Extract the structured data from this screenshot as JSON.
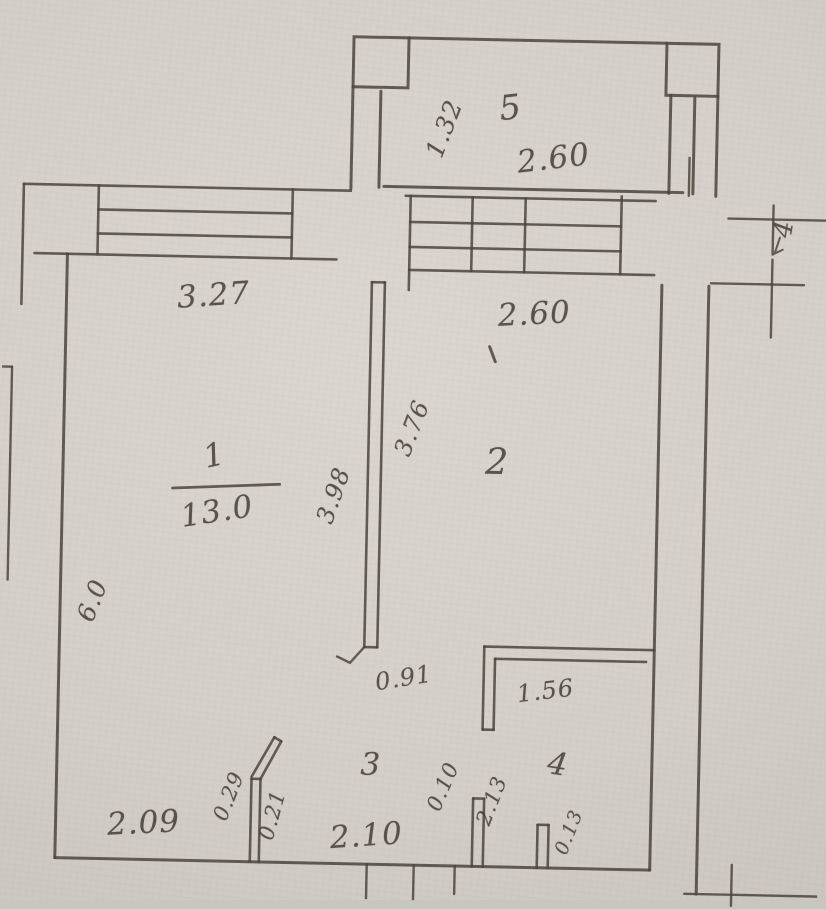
{
  "document": {
    "kind": "scanned hand-drawn apartment floor plan",
    "aria": "Scanned floor plan of an apartment with rooms 1-5 and handwritten dimensions"
  },
  "palette": {
    "paper": "#d4d0c9",
    "ink": "#4b453c",
    "text": "#3e382f"
  },
  "rooms": [
    {
      "number": "1",
      "area": "13.0",
      "width": "3.27",
      "depth": "3.98"
    },
    {
      "number": "2",
      "width": "2.60",
      "depth": "3.76"
    },
    {
      "number": "3",
      "dims": [
        "2.09",
        "0.29",
        "0.21",
        "2.10"
      ]
    },
    {
      "number": "4",
      "dims": [
        "0.10",
        "2.13",
        "0.13"
      ],
      "niche": "1.56"
    },
    {
      "number": "5",
      "width": "2.60",
      "depth": "1.32"
    }
  ],
  "doors": [
    {
      "between": "1-2",
      "width": "0.91"
    }
  ],
  "side_marks": [
    {
      "text": "4",
      "position": "right margin"
    }
  ],
  "plan": {
    "labels": [
      {
        "name": "room-5-number-label",
        "text": "5",
        "x": 503,
        "y": 106,
        "size": 34,
        "rot": -8
      },
      {
        "name": "balcony-width-dim",
        "text": "2.60",
        "x": 547,
        "y": 156,
        "size": 31,
        "rot": -8
      },
      {
        "name": "balcony-depth-dim",
        "text": "1.32",
        "x": 437,
        "y": 128,
        "size": 25,
        "rot": -70
      },
      {
        "name": "room-1-width-dim",
        "text": "3.27",
        "x": 210,
        "y": 300,
        "size": 31,
        "rot": -5
      },
      {
        "name": "room-2-width-dim",
        "text": "2.60",
        "x": 531,
        "y": 312,
        "size": 31,
        "rot": -4
      },
      {
        "name": "room-1-number-label",
        "text": "1",
        "x": 214,
        "y": 459,
        "size": 32,
        "rot": -14
      },
      {
        "name": "room-1-area-label",
        "text": "13.0",
        "x": 218,
        "y": 516,
        "size": 31,
        "rot": -10
      },
      {
        "name": "room-1-depth-dim",
        "text": "6.0",
        "x": 95,
        "y": 607,
        "size": 25,
        "rot": -70
      },
      {
        "name": "wall-1-2-dim-left",
        "text": "3.98",
        "x": 334,
        "y": 497,
        "size": 24,
        "rot": -72
      },
      {
        "name": "wall-1-2-dim-right",
        "text": "3.76",
        "x": 411,
        "y": 428,
        "size": 24,
        "rot": -70
      },
      {
        "name": "room-2-number-label",
        "text": "2",
        "x": 497,
        "y": 461,
        "size": 36,
        "rot": 0
      },
      {
        "name": "door-1-2-width-dim",
        "text": "0.91",
        "x": 408,
        "y": 678,
        "size": 24,
        "rot": -10
      },
      {
        "name": "niche-width-dim",
        "text": "1.56",
        "x": 550,
        "y": 688,
        "size": 24,
        "rot": -8
      },
      {
        "name": "room-3-number-label",
        "text": "3",
        "x": 377,
        "y": 766,
        "size": 31,
        "rot": 0
      },
      {
        "name": "room-4-number-label",
        "text": "4",
        "x": 564,
        "y": 762,
        "size": 31,
        "rot": 8
      },
      {
        "name": "room-3-left-dim",
        "text": "2.09",
        "x": 151,
        "y": 829,
        "size": 31,
        "rot": -4
      },
      {
        "name": "partition-dim-left",
        "text": "0.29",
        "x": 236,
        "y": 800,
        "size": 21,
        "rot": -70
      },
      {
        "name": "partition-dim-right",
        "text": "0.21",
        "x": 280,
        "y": 818,
        "size": 21,
        "rot": -76
      },
      {
        "name": "room-3-right-dim",
        "text": "2.10",
        "x": 374,
        "y": 837,
        "size": 31,
        "rot": -5
      },
      {
        "name": "door-3-4-dim",
        "text": "0.10",
        "x": 450,
        "y": 786,
        "size": 21,
        "rot": -68
      },
      {
        "name": "room-4-depth-dim",
        "text": "2.13",
        "x": 499,
        "y": 799,
        "size": 21,
        "rot": -70
      },
      {
        "name": "corner-wall-dim",
        "text": "0.13",
        "x": 577,
        "y": 829,
        "size": 19,
        "rot": -70
      },
      {
        "name": "stair-side-mark",
        "text": "4",
        "x": 779,
        "y": 221,
        "size": 26,
        "rot": -82
      }
    ]
  }
}
